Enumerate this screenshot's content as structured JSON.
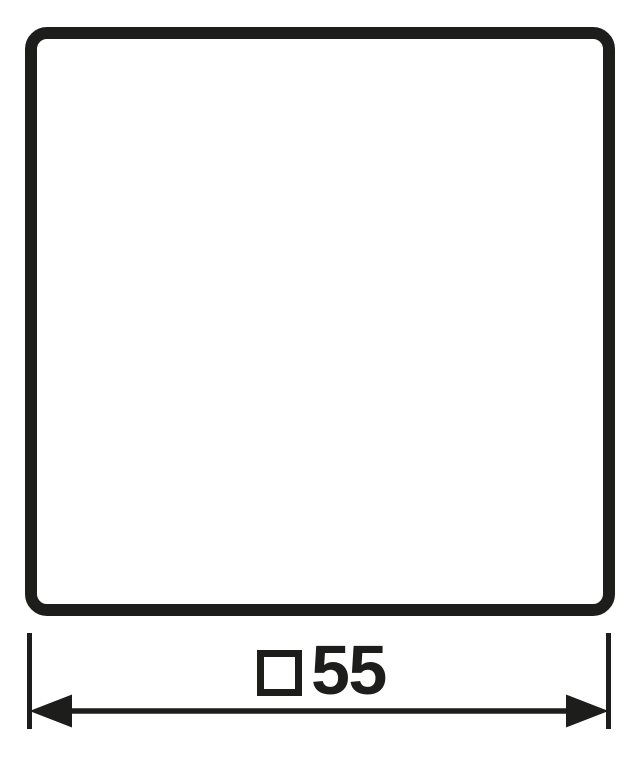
{
  "drawing": {
    "plate": {
      "shape": "rounded-square",
      "outline_color": "#1d1d1b",
      "fill_color": "#ffffff"
    },
    "dimension": {
      "symbol": "□",
      "symbol_name": "square-symbol",
      "value": "55",
      "display": "□55"
    },
    "colors": {
      "line": "#1d1d1b",
      "background": "#ffffff"
    }
  }
}
